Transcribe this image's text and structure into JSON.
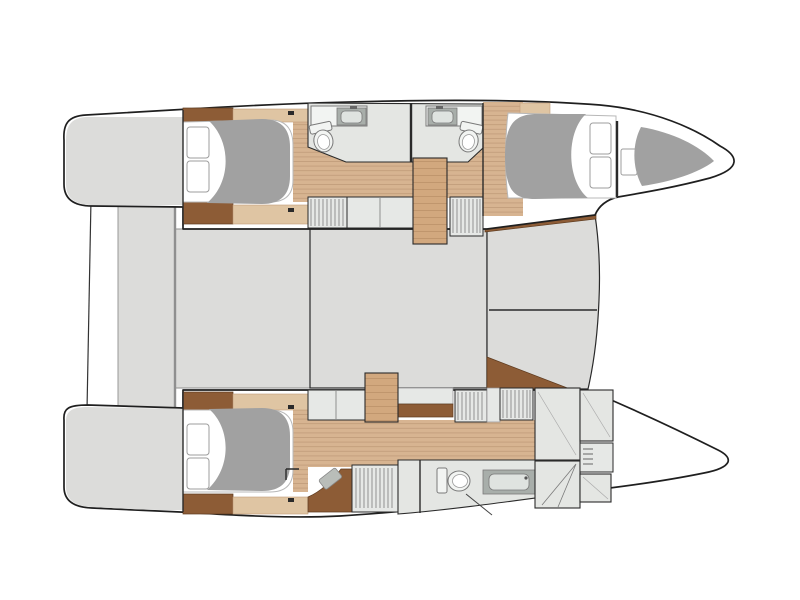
{
  "title": "Catamaran yacht layout floor plan (top view)",
  "canvas": {
    "width": 800,
    "height": 600,
    "background": "#ffffff"
  },
  "palette": {
    "background": "#ffffff",
    "outline": "#1f1f1f",
    "wall": "#2a2a2a",
    "deck": "#dcdcda",
    "deck_line": "#8f8f8f",
    "wood": "#d7b491",
    "wood_line": "#c09c79",
    "wood_stair": "#d2a87e",
    "wood_shelf": "#dfc5a3",
    "brown": "#8d5c36",
    "brown_dark": "#5d3a1e",
    "bath_floor": "#e4e6e3",
    "cabinet": "#e6e8e6",
    "hatch_line": "#7c7c7c",
    "fixture": "#f2f4f2",
    "fixture_line": "#7a7a7a",
    "counter": "#a8aeaa",
    "sink": "#dfe3e0",
    "duvet": "#a1a1a1",
    "mattress": "#ffffff",
    "mattress_line": "#b8b8b8",
    "pillow_line": "#9c9c9c"
  },
  "plan": {
    "orientation": "bow-right",
    "port_hull_rooms": [
      "swim-platform",
      "aft-double-cabin",
      "bathroom",
      "bathroom",
      "companionway-stairs",
      "forward-double-cabin",
      "forepeak-berth"
    ],
    "starboard_hull_rooms": [
      "swim-platform",
      "aft-double-cabin",
      "corridor",
      "companionway-stairs",
      "bathroom-with-shower",
      "storage-compartments"
    ],
    "bridge_deck_areas": [
      "aft-cockpit",
      "saloon",
      "foredeck",
      "trampoline-area"
    ],
    "visible_fixtures": {
      "double-berths": 4,
      "pillows": 7,
      "toilets": 3,
      "sink-counters": 3,
      "showers": 1,
      "wardrobe-lockers": 6,
      "companionway-stairs": 2,
      "swim-platforms": 2
    }
  }
}
